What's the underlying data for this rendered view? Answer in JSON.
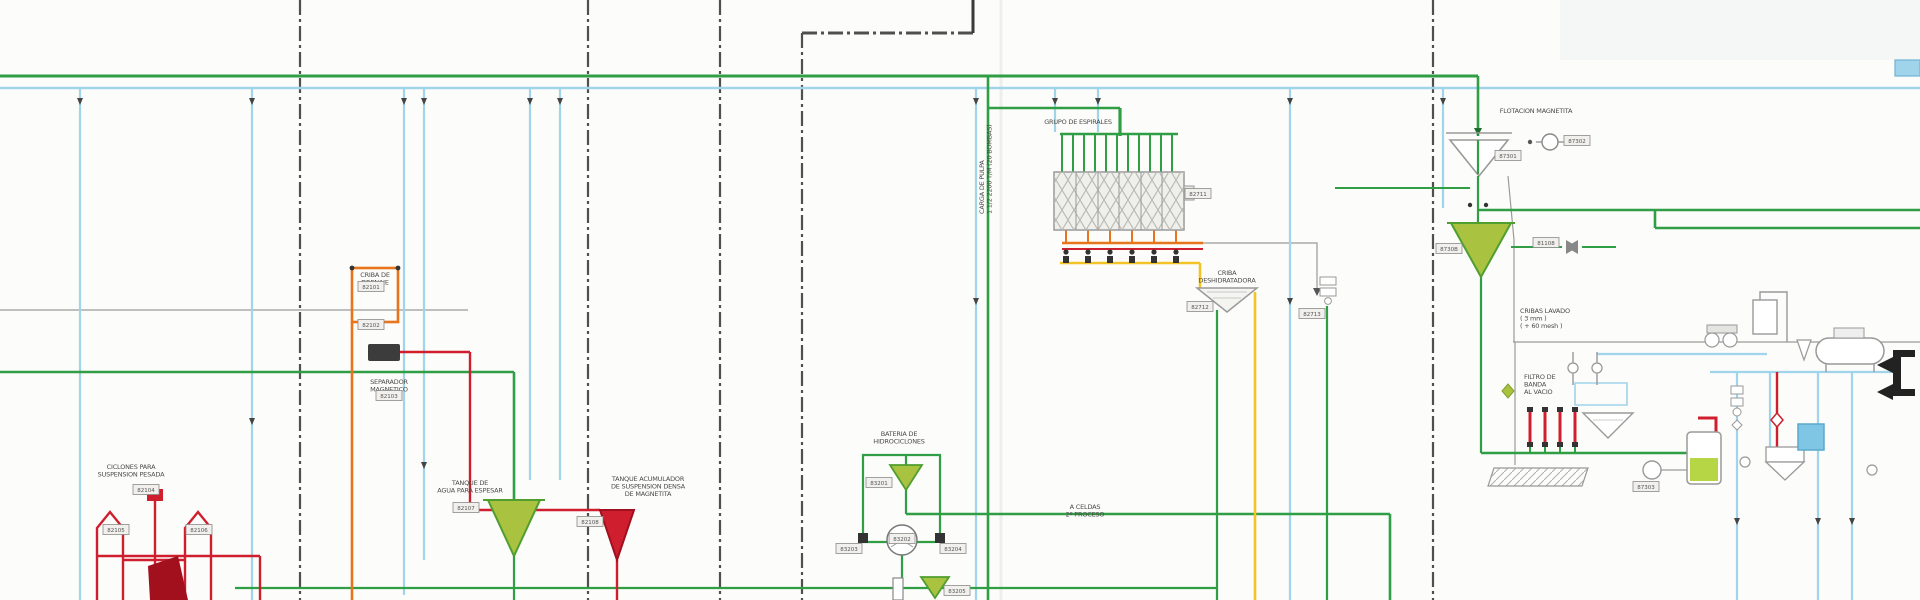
{
  "diagram": {
    "kind": "process-flow-diagram",
    "language": "es",
    "description": "Mineral processing plant flowsheet section: heavy-media cyclones, magnetic separator, hydrocyclone battery, spiral group, magnetite flotation, washing screens and vacuum belt filter"
  },
  "colors": {
    "process_green": "#2f9e44",
    "water_cyan": "#9fd4ea",
    "media_orange": "#e8741c",
    "middlings_yellow": "#f2c428",
    "dense_red": "#cf1f2e",
    "dark_red": "#a2101e",
    "olive_fill": "#a9c23f",
    "equipment_grey": "#999999",
    "dashline_dark": "#4f4f4f",
    "paper": "#fcfcfa"
  },
  "labels": [
    {
      "id": "ciclones-label",
      "lines": [
        "CICLONES PARA",
        "SUSPENSION PESADA"
      ],
      "x": 131,
      "y": 469,
      "anchor": "middle",
      "rotate": 0
    },
    {
      "id": "separador-label",
      "lines": [
        "SEPARADOR",
        "MAGNETICO"
      ],
      "x": 389,
      "y": 384,
      "anchor": "middle",
      "rotate": 0
    },
    {
      "id": "criba-drenaje-label",
      "lines": [
        "CRIBA DE",
        "DRENAJE"
      ],
      "x": 375,
      "y": 277,
      "anchor": "middle",
      "rotate": 0
    },
    {
      "id": "tanque-agua-label",
      "lines": [
        "TANQUE DE",
        "AGUA PARA ESPESAR"
      ],
      "x": 470,
      "y": 485,
      "anchor": "middle",
      "rotate": 0
    },
    {
      "id": "tanque-acumulador-label",
      "lines": [
        "TANQUE ACUMULADOR",
        "DE SUSPENSION DENSA",
        "DE MAGNETITA"
      ],
      "x": 648,
      "y": 481,
      "anchor": "middle",
      "rotate": 0
    },
    {
      "id": "bateria-label",
      "lines": [
        "BATERIA DE",
        "HIDROCICLONES"
      ],
      "x": 899,
      "y": 436,
      "anchor": "middle",
      "rotate": 0
    },
    {
      "id": "grupo-espirales-label",
      "lines": [
        "GRUPO DE ESPIRALES"
      ],
      "x": 1078,
      "y": 124,
      "anchor": "middle",
      "rotate": 0
    },
    {
      "id": "carga-pulpa-label",
      "lines": [
        "CARGA DE PULPA",
        "1 1/2  2200 T/M (20 BOMBAS)"
      ],
      "x": 984,
      "y": 214,
      "anchor": "start",
      "rotate": -90
    },
    {
      "id": "criba-deshidratadora-label",
      "lines": [
        "CRIBA",
        "DESHIDRATADORA"
      ],
      "x": 1227,
      "y": 275,
      "anchor": "middle",
      "rotate": 0
    },
    {
      "id": "a-celdas-label",
      "lines": [
        "A CELDAS",
        "2º PROCESO"
      ],
      "x": 1085,
      "y": 509,
      "anchor": "middle",
      "rotate": 0
    },
    {
      "id": "flotacion-label",
      "lines": [
        "FLOTACION  MAGNETITA"
      ],
      "x": 1536,
      "y": 113,
      "anchor": "middle",
      "rotate": 0
    },
    {
      "id": "cribas-lavado-label",
      "lines": [
        "CRIBAS LAVADO",
        "( 3 mm )",
        "( + 60 mesh )"
      ],
      "x": 1520,
      "y": 313,
      "anchor": "start",
      "rotate": 0
    },
    {
      "id": "filtro-banda-label",
      "lines": [
        "FILTRO DE",
        "BANDA",
        "AL VACIO"
      ],
      "x": 1524,
      "y": 379,
      "anchor": "start",
      "rotate": 0
    }
  ],
  "tags": [
    {
      "value": "82101",
      "x": 371,
      "y": 287
    },
    {
      "value": "82102",
      "x": 371,
      "y": 325
    },
    {
      "value": "82103",
      "x": 389,
      "y": 396
    },
    {
      "value": "82104",
      "x": 146,
      "y": 490
    },
    {
      "value": "82105",
      "x": 116,
      "y": 530
    },
    {
      "value": "82106",
      "x": 199,
      "y": 530
    },
    {
      "value": "82107",
      "x": 466,
      "y": 508
    },
    {
      "value": "82108",
      "x": 590,
      "y": 522
    },
    {
      "value": "83201",
      "x": 879,
      "y": 483
    },
    {
      "value": "83202",
      "x": 902,
      "y": 539
    },
    {
      "value": "83203",
      "x": 849,
      "y": 549
    },
    {
      "value": "83204",
      "x": 953,
      "y": 549
    },
    {
      "value": "83205",
      "x": 957,
      "y": 591
    },
    {
      "value": "82711",
      "x": 1198,
      "y": 194
    },
    {
      "value": "82712",
      "x": 1200,
      "y": 307
    },
    {
      "value": "82713",
      "x": 1312,
      "y": 314
    },
    {
      "value": "87301",
      "x": 1508,
      "y": 156
    },
    {
      "value": "87302",
      "x": 1577,
      "y": 141
    },
    {
      "value": "8730B",
      "x": 1449,
      "y": 249
    },
    {
      "value": "81108",
      "x": 1546,
      "y": 243
    },
    {
      "value": "87303",
      "x": 1646,
      "y": 487
    }
  ]
}
